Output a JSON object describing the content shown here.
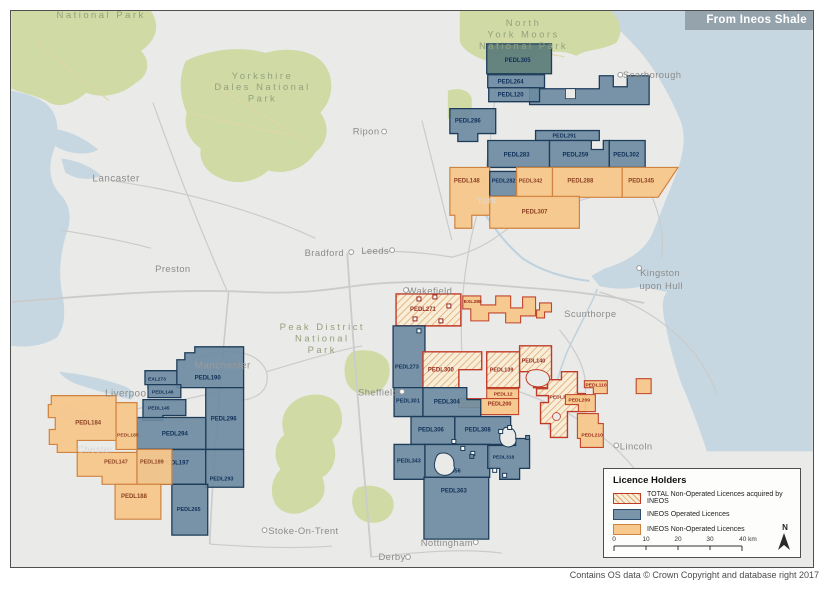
{
  "banner": {
    "credit": "From Ineos Shale"
  },
  "footer": {
    "copyright": "Contains OS data © Crown Copyright and database right 2017"
  },
  "legend": {
    "title": "Licence Holders",
    "items": [
      {
        "type": "total",
        "label": "TOTAL Non-Operated Licences acquired by INEOS"
      },
      {
        "type": "operated",
        "label": "INEOS Operated Licences"
      },
      {
        "type": "nonop",
        "label": "INEOS Non-Operated Licences"
      }
    ],
    "scale_ticks": [
      "0",
      "10",
      "20",
      "30",
      "40 km"
    ],
    "north_label": "N"
  },
  "colors": {
    "sea": "#c6d7e1",
    "land": "#eaeae8",
    "park": "#cfdaa5",
    "road": "#cbcbcb",
    "park_road": "#ded7a6",
    "river": "#bdd2de",
    "operated_fill": "#6e8ba1",
    "operated_dark_fill": "#5e7e79",
    "operated_border": "#1c3c5a",
    "operated_label": "#10305a",
    "nonop_fill": "#f7c78b",
    "nonop_border": "#d0823f",
    "nonop_label": "#8d4223",
    "red_border": "#c2452c",
    "red_label": "#97291a",
    "total_fill": "#f8eed8",
    "total_hatch": "#e0a770",
    "total_border": "#c03a28",
    "city_label": "#8c8c8c",
    "park_label": "#95a07d"
  },
  "map": {
    "park_labels": [
      {
        "lines": [
          "National Park"
        ],
        "x": 100,
        "y": 17
      },
      {
        "lines": [
          "North",
          "York Moors",
          "National Park"
        ],
        "x": 524,
        "y": 25
      },
      {
        "lines": [
          "Yorkshire",
          "Dales National",
          "Park"
        ],
        "x": 262,
        "y": 78
      },
      {
        "lines": [
          "Peak District",
          "National",
          "Park"
        ],
        "x": 322,
        "y": 330
      }
    ],
    "places": [
      {
        "name": "Lancaster",
        "x": 115,
        "y": 181,
        "fs": 10
      },
      {
        "name": "Preston",
        "x": 172,
        "y": 272,
        "fs": 9.5
      },
      {
        "name": "Ripon",
        "x": 366,
        "y": 134,
        "fs": 9.5,
        "dot": [
          384,
          131
        ]
      },
      {
        "name": "Scarborough",
        "x": 653,
        "y": 77,
        "fs": 9.5,
        "dot": [
          621,
          74
        ]
      },
      {
        "name": "York",
        "x": 487,
        "y": 203,
        "fs": 9.5,
        "color": "#dcdcdc"
      },
      {
        "name": "Leeds",
        "x": 375,
        "y": 254,
        "fs": 9.5,
        "dot": [
          392,
          250
        ]
      },
      {
        "name": "Bradford",
        "x": 324,
        "y": 256,
        "fs": 9.5,
        "dot": [
          351,
          252
        ]
      },
      {
        "name": "Wakefield",
        "x": 430,
        "y": 294,
        "fs": 9.5,
        "dot": [
          406,
          290
        ]
      },
      {
        "name": "Kingston",
        "x": 661,
        "y": 276,
        "fs": 9.5,
        "dot": [
          640,
          268
        ]
      },
      {
        "name": "upon Hull",
        "x": 662,
        "y": 289,
        "fs": 9.5
      },
      {
        "name": "Scunthorpe",
        "x": 591,
        "y": 317,
        "fs": 9.5
      },
      {
        "name": "Manchester",
        "x": 222,
        "y": 369,
        "fs": 10,
        "color": "#9a9a9a"
      },
      {
        "name": "Liverpool",
        "x": 126,
        "y": 397,
        "fs": 10
      },
      {
        "name": "Chester",
        "x": 94,
        "y": 453,
        "fs": 9.5,
        "color": "#d8d8d8"
      },
      {
        "name": "Sheffield",
        "x": 378,
        "y": 396,
        "fs": 9.5,
        "dot": [
          402,
          392
        ]
      },
      {
        "name": "Stoke-On-Trent",
        "x": 303,
        "y": 535,
        "fs": 9.5,
        "dot": [
          264,
          531
        ]
      },
      {
        "name": "Derby",
        "x": 392,
        "y": 561,
        "fs": 9.5,
        "dot": [
          408,
          558
        ]
      },
      {
        "name": "Nottingham",
        "x": 447,
        "y": 547,
        "fs": 9.5,
        "dot": [
          476,
          543
        ]
      },
      {
        "name": "Lincoln",
        "x": 637,
        "y": 450,
        "fs": 9.5,
        "dot": [
          617,
          446
        ]
      }
    ],
    "licences": [
      {
        "label": "PEDL305",
        "cls": "opdark",
        "lx": 505,
        "ly": 61,
        "pts": "487,43 552,43 552,73 487,73"
      },
      {
        "label": "",
        "cls": "op",
        "lx": 0,
        "ly": 0,
        "pts": "530,88 600,88 600,75 614,75 614,86 628,86 628,75 650,75 650,104 530,104"
      },
      {
        "label": "PEDL264",
        "cls": "op",
        "lx": 498,
        "ly": 83,
        "pts": "488,74 545,74 545,87 488,87"
      },
      {
        "label": "PEDL120",
        "cls": "op",
        "lx": 498,
        "ly": 96,
        "pts": "489,87 540,87 540,101 489,101"
      },
      {
        "label": "PEDL286",
        "cls": "op",
        "lx": 455,
        "ly": 122,
        "pts": "450,108 496,108 496,133 478,133 478,141 458,141 458,133 450,133"
      },
      {
        "label": "PEDL291",
        "cls": "op",
        "fs": 5.5,
        "lx": 553,
        "ly": 137,
        "pts": "536,130 600,130 600,140 536,140"
      },
      {
        "label": "PEDL283",
        "cls": "op",
        "lx": 504,
        "ly": 156,
        "pts": "488,140 550,140 550,167 488,167"
      },
      {
        "label": "PEDL259",
        "cls": "op",
        "lx": 563,
        "ly": 156,
        "pts": "550,140 592,140 592,149 604,149 604,140 610,140 610,167 550,167"
      },
      {
        "label": "PEDL302",
        "cls": "op",
        "lx": 614,
        "ly": 156,
        "pts": "610,140 646,140 646,167 610,167"
      },
      {
        "label": "PEDL148",
        "cls": "no",
        "lx": 454,
        "ly": 182,
        "pts": "450,167 490,167 490,215 472,215 472,228 455,228 455,215 450,215"
      },
      {
        "label": "PEDL282",
        "cls": "op",
        "fs": 5.5,
        "lx": 492,
        "ly": 182,
        "pts": "490,171 517,171 517,196 490,196"
      },
      {
        "label": "PEDL342",
        "cls": "no",
        "fs": 5.5,
        "lx": 519,
        "ly": 182,
        "pts": "517,167 553,167 553,197 517,197"
      },
      {
        "label": "PEDL288",
        "cls": "no",
        "lx": 568,
        "ly": 182,
        "pts": "553,167 623,167 623,197 553,197"
      },
      {
        "label": "PEDL345",
        "cls": "no",
        "lx": 629,
        "ly": 182,
        "pts": "623,167 679,167 659,197 623,197"
      },
      {
        "label": "PEDL307",
        "cls": "no",
        "lx": 522,
        "ly": 213,
        "pts": "490,196 580,196 580,228 490,228"
      },
      {
        "label": "PEDL271",
        "cls": "tot",
        "lx": 410,
        "ly": 311,
        "pts": "396,294 461,294 461,326 396,326"
      },
      {
        "label": "EXL288",
        "cls": "nored",
        "fs": 5,
        "lx": 464,
        "ly": 303,
        "pts": "463,296 481,296 481,305 496,305 496,296 511,296 511,308 523,308 523,297 536,297 536,316 521,316 521,323 506,323 506,313 489,313 489,321 471,321 471,309 463,309"
      },
      {
        "label": "",
        "cls": "nored",
        "lx": 0,
        "ly": 0,
        "pts": "540,303 552,303 552,312 545,312 545,318 537,318 537,310 540,310"
      },
      {
        "label": "PEDL273",
        "cls": "op",
        "fs": 5.5,
        "lx": 395,
        "ly": 369,
        "pts": "393,326 425,326 425,388 393,388"
      },
      {
        "label": "PEDL300",
        "cls": "tot",
        "lx": 428,
        "ly": 372,
        "pts": "423,352 482,352 482,370 459,370 459,388 423,388"
      },
      {
        "label": "PEDL139",
        "cls": "tot",
        "fs": 5.5,
        "lx": 490,
        "ly": 372,
        "pts": "487,352 520,352 520,388 487,388"
      },
      {
        "label": "PEDL140",
        "cls": "tot",
        "fs": 5.5,
        "lx": 522,
        "ly": 363,
        "pts": "520,346 552,346 552,388 534,388 534,372 520,372"
      },
      {
        "label": "PEDL316",
        "cls": "tot",
        "fs": 5,
        "lx": 550,
        "ly": 399,
        "pts": "537,389 548,389 548,380 562,380 562,372 578,372 578,394 586,394 586,412 568,412 568,438 551,438 551,424 541,424 541,403 549,403 549,396 537,396"
      },
      {
        "label": "PEDL12",
        "cls": "nored",
        "fs": 5,
        "lx": 494,
        "ly": 396,
        "pts": "487,389 519,389 519,399 487,399"
      },
      {
        "label": "PEDL200",
        "cls": "nored",
        "fs": 5.5,
        "lx": 488,
        "ly": 406,
        "pts": "459,399 519,399 519,415 481,415 481,408 459,408"
      },
      {
        "label": "PEDL209",
        "cls": "nored",
        "fs": 5,
        "lx": 569,
        "ly": 402,
        "pts": "566,395 596,395 596,412 579,412 579,405 566,405"
      },
      {
        "label": "PEDL110",
        "cls": "nored",
        "fs": 5,
        "lx": 586,
        "ly": 387,
        "pts": "585,381 608,381 608,394 594,394 594,388 585,388"
      },
      {
        "label": "PEDL210",
        "cls": "nored",
        "fs": 5,
        "lx": 582,
        "ly": 437,
        "pts": "578,414 599,414 599,424 604,424 604,448 581,448 581,439 578,439"
      },
      {
        "label": "",
        "cls": "nored",
        "lx": 0,
        "ly": 0,
        "pts": "637,379 652,379 652,394 637,394"
      },
      {
        "label": "PEDL301",
        "cls": "op",
        "fs": 5.5,
        "lx": 396,
        "ly": 403,
        "pts": "394,388 423,388 423,417 394,417"
      },
      {
        "label": "PEDL304",
        "cls": "op",
        "lx": 434,
        "ly": 404,
        "pts": "423,388 467,388 467,400 481,400 481,417 423,417"
      },
      {
        "label": "PEDL306",
        "cls": "op",
        "lx": 418,
        "ly": 432,
        "pts": "411,417 455,417 455,445 411,445"
      },
      {
        "label": "PEDL308",
        "cls": "op",
        "lx": 465,
        "ly": 432,
        "pts": "455,417 511,417 511,445 455,445"
      },
      {
        "label": "PEDL343",
        "cls": "op",
        "fs": 5.5,
        "lx": 397,
        "ly": 463,
        "pts": "394,445 425,445 425,480 394,480"
      },
      {
        "label": "PEDL356",
        "cls": "op",
        "fs": 5.5,
        "lx": 437,
        "ly": 473,
        "pts": "425,445 490,445 490,478 425,478"
      },
      {
        "label": "PEDL363",
        "cls": "op",
        "lx": 441,
        "ly": 493,
        "pts": "424,478 489,478 489,540 424,540"
      },
      {
        "label": "PEDL318",
        "cls": "op",
        "fs": 5,
        "lx": 493,
        "ly": 459,
        "pts": "488,446 516,446 516,439 530,439 530,469 520,469 520,480 500,480 500,469 488,469"
      },
      {
        "label": "PEDL190",
        "cls": "op",
        "lx": 194,
        "ly": 380,
        "pts": "176,360 184,360 184,353 194,353 194,347 243,347 243,388 176,388"
      },
      {
        "label": "EXL273",
        "cls": "op",
        "fs": 5,
        "lx": 147,
        "ly": 381,
        "pts": "144,371 176,371 176,385 144,385"
      },
      {
        "label": "PEDL146",
        "cls": "op",
        "fs": 5,
        "lx": 151,
        "ly": 394,
        "pts": "147,385 180,385 180,398 147,398"
      },
      {
        "label": "PEDL145",
        "cls": "op",
        "fs": 5,
        "lx": 147,
        "ly": 410,
        "pts": "142,400 185,400 185,416 162,416 162,421 142,421"
      },
      {
        "label": "PEDL296",
        "cls": "op",
        "lx": 210,
        "ly": 421,
        "pts": "205,388 243,388 243,450 205,450"
      },
      {
        "label": "PEDL294",
        "cls": "op",
        "lx": 161,
        "ly": 436,
        "pts": "136,418 205,418 205,450 136,450"
      },
      {
        "label": "PEDL197",
        "cls": "op",
        "lx": 162,
        "ly": 465,
        "pts": "136,450 205,450 205,485 136,485"
      },
      {
        "label": "PEDL293",
        "cls": "op",
        "fs": 5.5,
        "lx": 209,
        "ly": 481,
        "pts": "205,450 243,450 243,488 205,488"
      },
      {
        "label": "PEDL265",
        "cls": "op",
        "fs": 5.5,
        "lx": 176,
        "ly": 512,
        "pts": "171,485 207,485 207,536 171,536"
      },
      {
        "label": "PEDL184",
        "cls": "no",
        "lx": 74,
        "ly": 425,
        "pts": "50,396 115,396 115,441 76,441 76,453 56,453 56,445 48,445 48,430 54,430 54,418 47,418 47,405 50,405"
      },
      {
        "label": "PEDL185",
        "cls": "no",
        "fs": 5,
        "lx": 116,
        "ly": 437,
        "pts": "115,403 136,403 136,450 115,450"
      },
      {
        "label": "PEDL147",
        "cls": "no",
        "fs": 5.5,
        "lx": 103,
        "ly": 464,
        "pts": "76,453 136,453 136,485 101,485 101,477 76,477"
      },
      {
        "label": "PEDL189",
        "cls": "no",
        "fs": 5.5,
        "lx": 139,
        "ly": 464,
        "pts": "136,450 171,450 171,485 136,485"
      },
      {
        "label": "PEDL188",
        "cls": "no",
        "lx": 120,
        "ly": 499,
        "pts": "114,485 160,485 160,520 114,520"
      }
    ]
  }
}
